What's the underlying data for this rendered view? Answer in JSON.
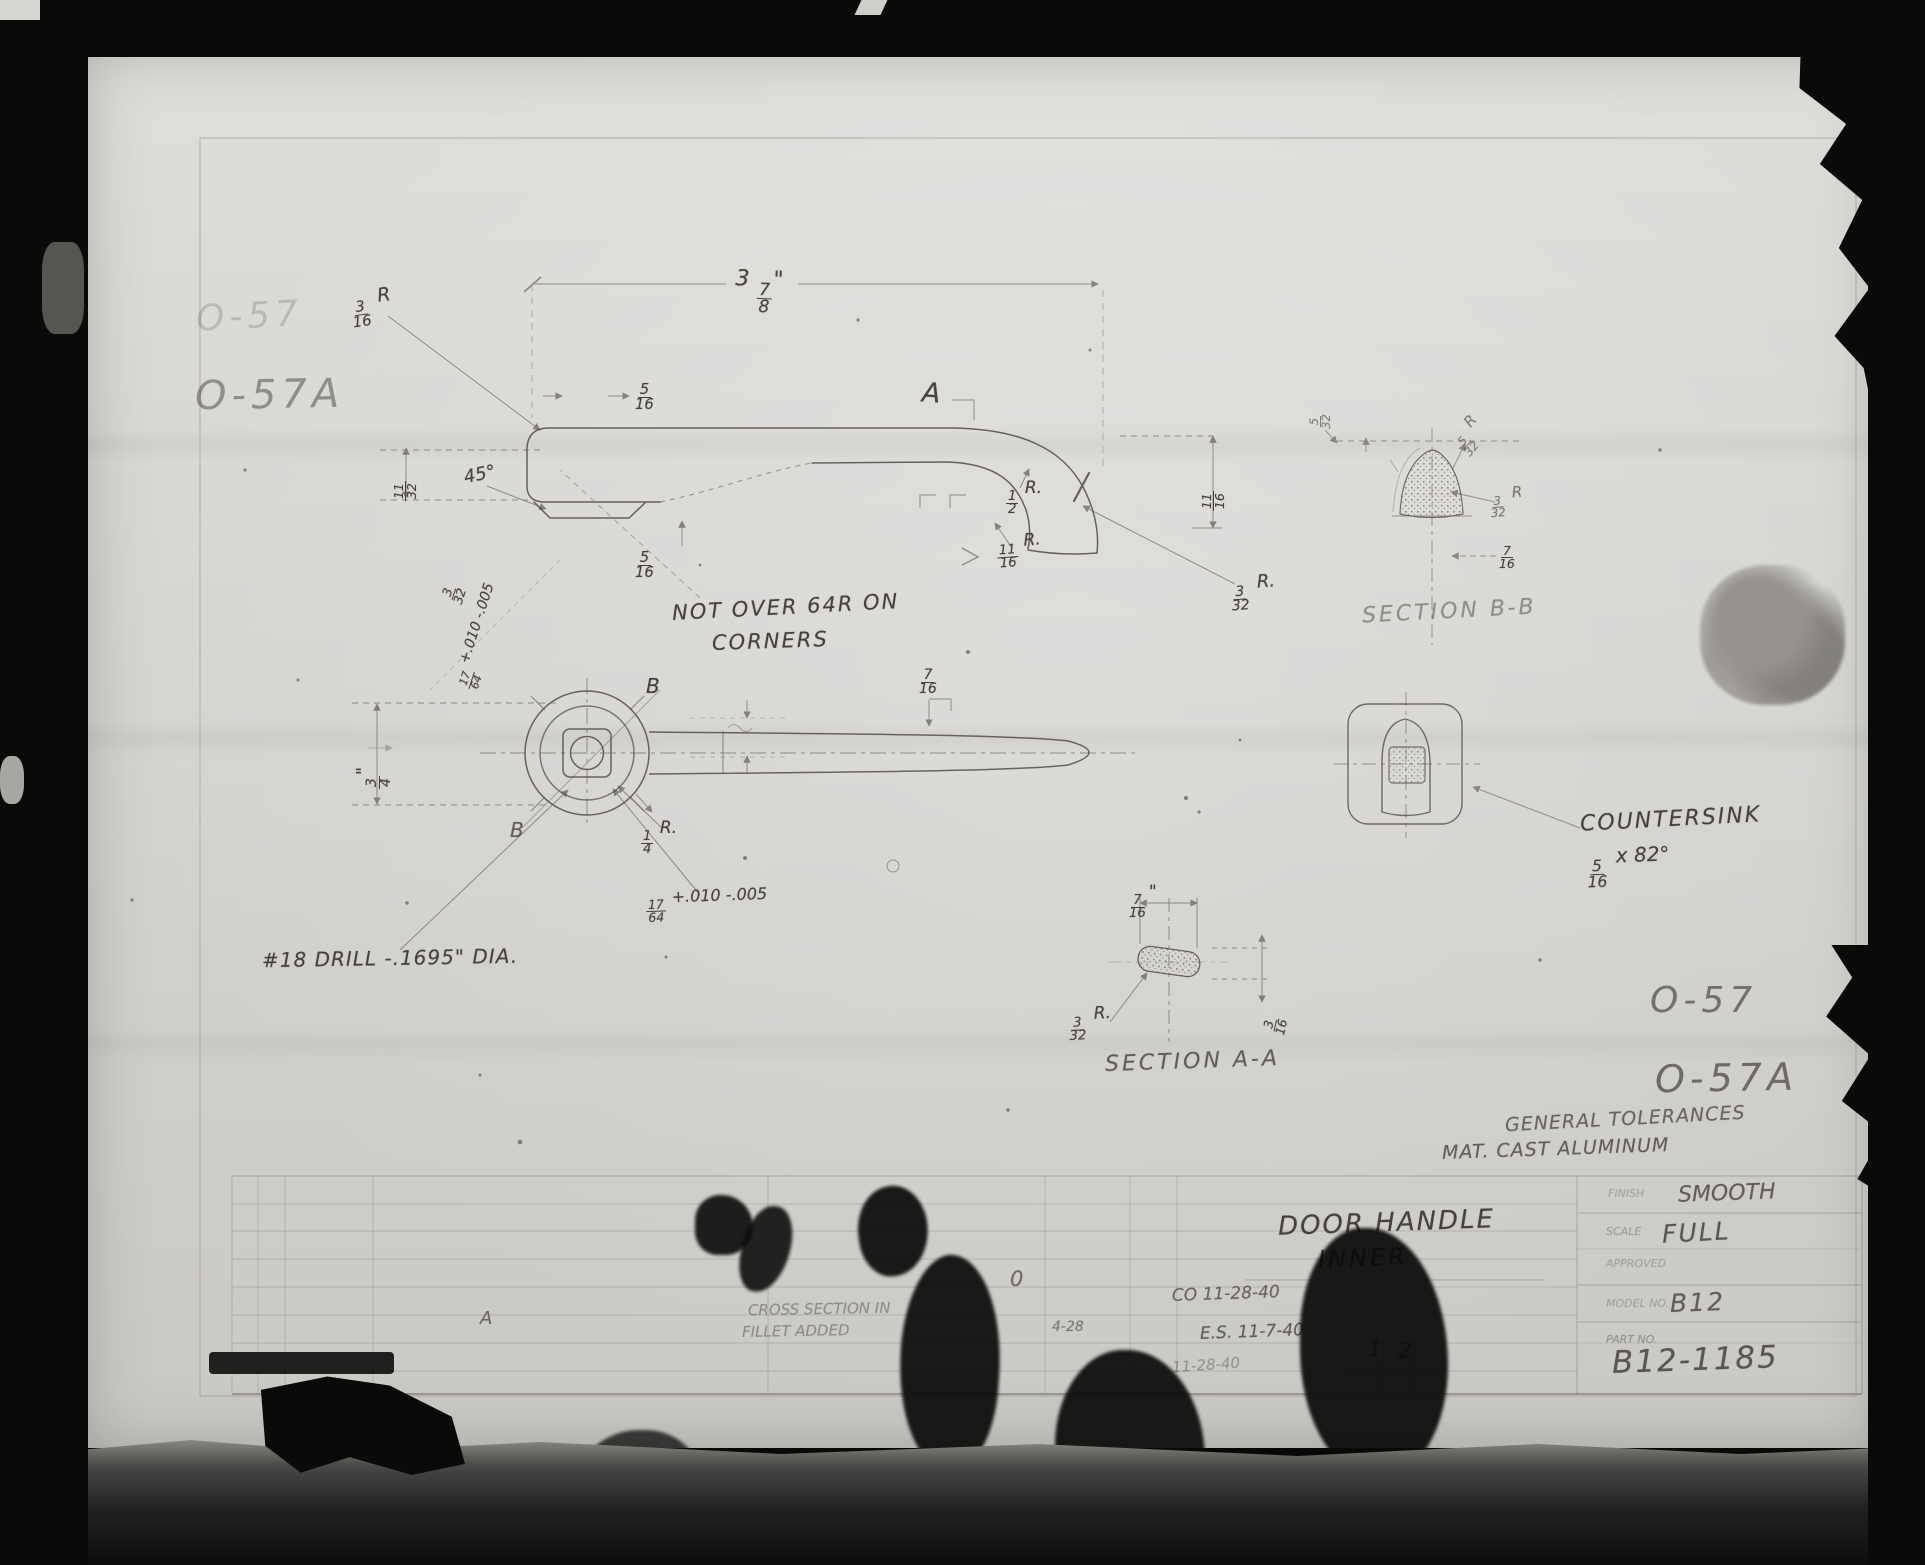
{
  "sheet": {
    "stamps": {
      "top_left_faded": "O-57",
      "top_left": "O-57A",
      "right_top": "O-57",
      "right_bottom": "O-57A"
    },
    "side_view": {
      "overall_length": "3 7/8\"",
      "corner_radius": "3/16 R",
      "boss_width": "5/16",
      "section_marker_top": "A",
      "chamfer_angle": "45°",
      "left_height": "11/32",
      "hole_offset": "3/32",
      "hole_dim_tol": "17/64 +.010 -.005",
      "notch_width": "5/16",
      "hook_inner_radius": "1/2 R.",
      "hook_mid_radius": "11/16 R.",
      "hook_tip_radius": "3/32 R.",
      "hook_drop": "11/16"
    },
    "front_view": {
      "corner_note_line1": "NOT OVER 64R ON",
      "corner_note_line2": "CORNERS",
      "section_marker_upper": "B",
      "section_marker_lower": "B",
      "boss_height": "3/4\"",
      "shaft_width": "7/16",
      "fillet_radius": "1/4 R.",
      "square_hole": "17/64 +.010 -.005",
      "drill_note": "#18 DRILL -.1695\" DIA."
    },
    "section_aa": {
      "title": "SECTION A-A",
      "width": "7/16\"",
      "end_radius": "3/32 R.",
      "thickness": "3/16"
    },
    "section_bb": {
      "title": "SECTION B-B",
      "depth": "5/32",
      "top_radius": "5/32 R",
      "side_radius": "3/32 R",
      "width": "7/16"
    },
    "end_view": {
      "countersink_line1": "COUNTERSINK",
      "countersink_line2": "5/16 x 82°"
    },
    "notes": {
      "tolerances": "GENERAL TOLERANCES",
      "material": "MAT. CAST ALUMINUM"
    },
    "title_block": {
      "part_name_line1": "DOOR HANDLE",
      "part_name_line2": "INNER",
      "finish_label": "FINISH",
      "finish": "SMOOTH",
      "scale_label": "SCALE",
      "scale": "FULL",
      "approved_label": "APPROVED",
      "model_label": "MODEL NO.",
      "model": "B12",
      "part_no_label": "PART NO.",
      "part_no": "B12-1185",
      "rev_marker": "A",
      "rev_note_line1": "CROSS SECTION IN",
      "rev_note_line2": "FILLET ADDED",
      "rev_date": "4-28",
      "date_1": "CO 11-28-40",
      "date_2": "E.S. 11-7-40",
      "date_3": "11-28-40",
      "sheet_current": "1",
      "sheet_total": "2",
      "stray_mark": "0"
    }
  }
}
